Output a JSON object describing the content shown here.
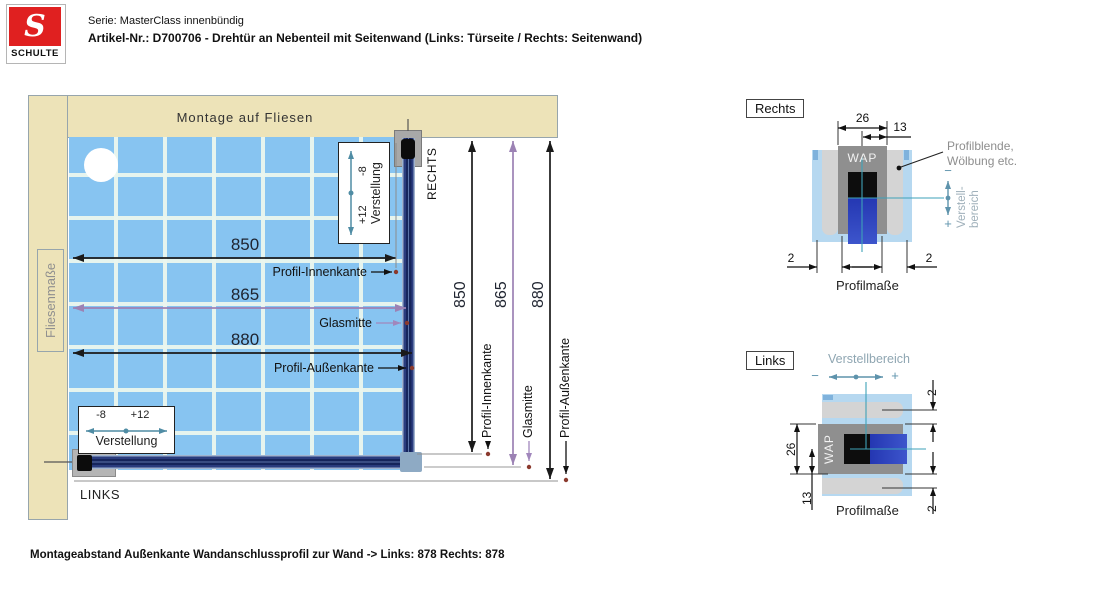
{
  "header": {
    "brand": "SCHULTE",
    "brand_letter": "S",
    "serie_line": "Serie: MasterClass innenbündig",
    "artikel_line": "Artikel-Nr.: D700706 - Drehtür an Nebenteil mit Seitenwand  (Links: Türseite / Rechts: Seitenwand)"
  },
  "plan": {
    "wall_top_label": "Montage auf Fliesen",
    "wall_left_label": "Fliesenmaße",
    "right_side_label": "RECHTS",
    "left_side_label": "LINKS",
    "h_dims": [
      {
        "value": "850",
        "leader": "Profil-Innenkante"
      },
      {
        "value": "865",
        "leader": "Glasmitte"
      },
      {
        "value": "880",
        "leader": "Profil-Außenkante"
      }
    ],
    "v_dims": [
      {
        "value": "850",
        "leader": "Profil-Innenkante"
      },
      {
        "value": "865",
        "leader": "Glasmitte"
      },
      {
        "value": "880",
        "leader": "Profil-Außenkante"
      }
    ],
    "adjust_vertical": {
      "neg": "-8",
      "pos": "+12",
      "label": "Verstellung"
    },
    "adjust_horizontal": {
      "neg": "-8",
      "pos": "+12",
      "label": "Verstellung"
    }
  },
  "detail_rechts": {
    "title": "Rechts",
    "wap_label": "WAP",
    "dim_total": "26",
    "dim_half": "13",
    "gap_left": "2",
    "gap_right": "2",
    "note_line1": "Profilblende,",
    "note_line2": "Wölbung etc.",
    "adjust": {
      "minus": "−",
      "plus": "+",
      "label_line1": "Verstell-",
      "label_line2": "bereich"
    },
    "caption": "Profilmaße"
  },
  "detail_links": {
    "title": "Links",
    "wap_label": "WAP",
    "adjust_label": "Verstellbereich",
    "minus": "−",
    "plus": "+",
    "dim_total": "26",
    "dim_half": "13",
    "gap_top": "2",
    "gap_bottom": "2",
    "caption": "Profilmaße"
  },
  "footer": {
    "note": "Montageabstand Außenkante Wandanschlussprofil zur Wand -> Links:  878  Rechts: 878"
  }
}
